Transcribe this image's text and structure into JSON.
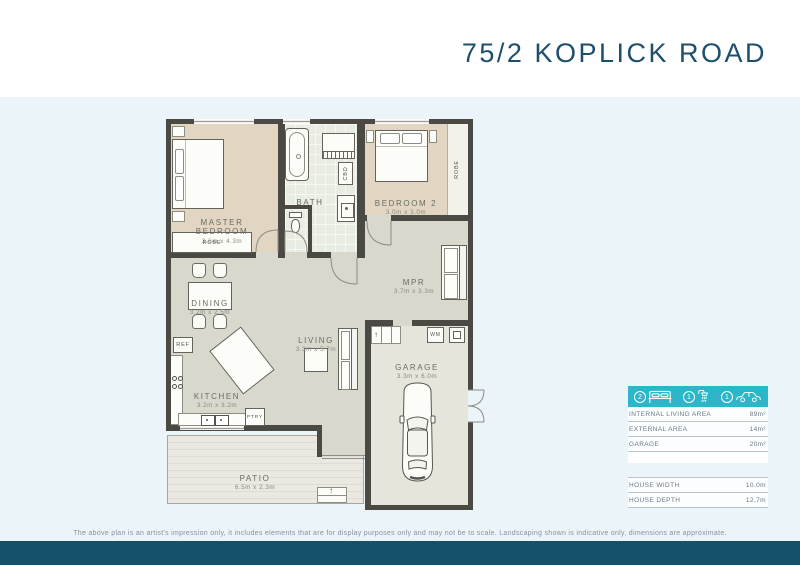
{
  "page": {
    "title": "75/2 KOPLICK ROAD"
  },
  "plan": {
    "rooms": {
      "master": {
        "name": "MASTER BEDROOM",
        "dims": "3.6m x 4.3m"
      },
      "bath": {
        "name": "BATH"
      },
      "bedroom2": {
        "name": "BEDROOM 2",
        "dims": "3.0m x 3.0m"
      },
      "mpr": {
        "name": "MPR",
        "dims": "3.7m x 3.3m"
      },
      "dining": {
        "name": "DINING",
        "dims": "3.2m x 2.5m"
      },
      "kitchen": {
        "name": "KITCHEN",
        "dims": "3.2m x 3.2m"
      },
      "living": {
        "name": "LIVING",
        "dims": "3.3m x 5.7m"
      },
      "garage": {
        "name": "GARAGE",
        "dims": "3.3m x 6.0m"
      },
      "patio": {
        "name": "PATIO",
        "dims": "6.5m x 2.3m"
      }
    },
    "fixtures": {
      "robe_master": "ROBE",
      "robe_bedroom2": "ROBE",
      "cbd": "CBD",
      "ref": "REF",
      "ptry": "PTRY",
      "wm": "WM",
      "step_arrow": "↑"
    }
  },
  "summary": {
    "features": [
      {
        "icon": "bed-icon",
        "count": "2"
      },
      {
        "icon": "shower-icon",
        "count": "1"
      },
      {
        "icon": "car-icon",
        "count": "1"
      }
    ],
    "area_rows": [
      {
        "label": "INTERNAL LIVING AREA",
        "value": "89m²"
      },
      {
        "label": "EXTERNAL AREA",
        "value": "14m²"
      },
      {
        "label": "GARAGE",
        "value": "20m²"
      }
    ],
    "dimension_rows": [
      {
        "label": "HOUSE WIDTH",
        "value": "10.0m"
      },
      {
        "label": "HOUSE DEPTH",
        "value": "12.7m"
      }
    ]
  },
  "footer": {
    "disclaimer": "The above plan is an artist's impression only, it includes elements that are for display purposes only and may not be to scale. Landscaping shown is indicative only, dimensions are approximate."
  },
  "colors": {
    "accent_teal": "#2bb6c9",
    "footer_navy": "#15506b",
    "title_navy": "#1d4e6c",
    "wall": "#4a4944"
  }
}
